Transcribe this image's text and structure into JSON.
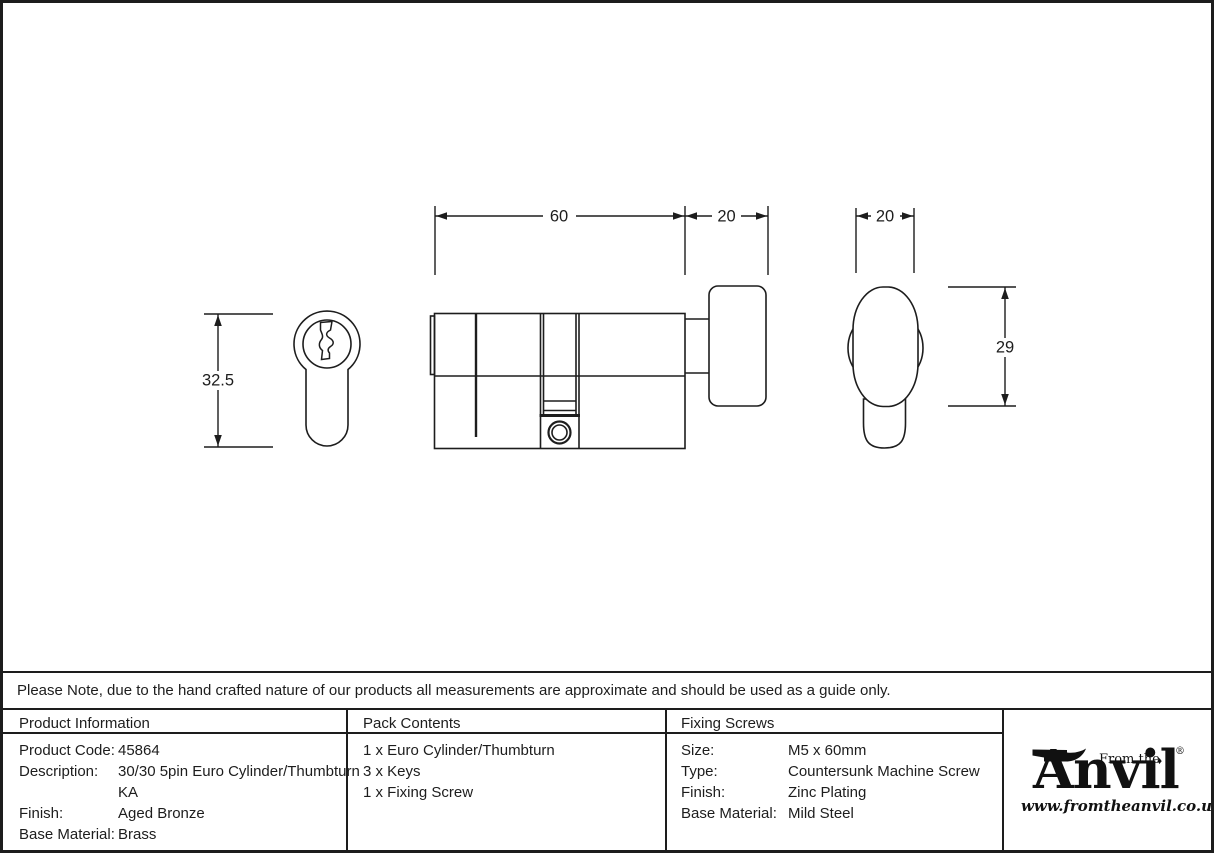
{
  "drawing": {
    "dimensions": {
      "cylinder_length": "60",
      "thumbturn_length": "20",
      "thumbturn_width": "20",
      "cylinder_height": "32.5",
      "thumbturn_height": "29"
    }
  },
  "note": "Please Note, due to the hand crafted nature of our products all measurements are approximate and should be used as a guide only.",
  "table": {
    "product_information": {
      "header": "Product Information",
      "rows": [
        {
          "label": "Product Code:",
          "value": "45864"
        },
        {
          "label": "Description:",
          "value": "30/30 5pin Euro Cylinder/Thumbturn KA"
        },
        {
          "label": "Finish:",
          "value": "Aged Bronze"
        },
        {
          "label": "Base Material:",
          "value": "Brass"
        }
      ]
    },
    "pack_contents": {
      "header": "Pack Contents",
      "items": [
        "1 x Euro Cylinder/Thumbturn",
        "3 x Keys",
        "1 x Fixing Screw"
      ]
    },
    "fixing_screws": {
      "header": "Fixing Screws",
      "rows": [
        {
          "label": "Size:",
          "value": "M5 x 60mm"
        },
        {
          "label": "Type:",
          "value": "Countersunk Machine Screw"
        },
        {
          "label": "Finish:",
          "value": "Zinc Plating"
        },
        {
          "label": "Base Material:",
          "value": "Mild Steel"
        }
      ]
    }
  },
  "logo": {
    "tagline": "From the",
    "diamond": "♦",
    "wordmark": "Anvil",
    "registered": "®",
    "url": "www.fromtheanvil.co.uk"
  },
  "colors": {
    "ink": "#1d1d1d",
    "background": "#ffffff"
  }
}
